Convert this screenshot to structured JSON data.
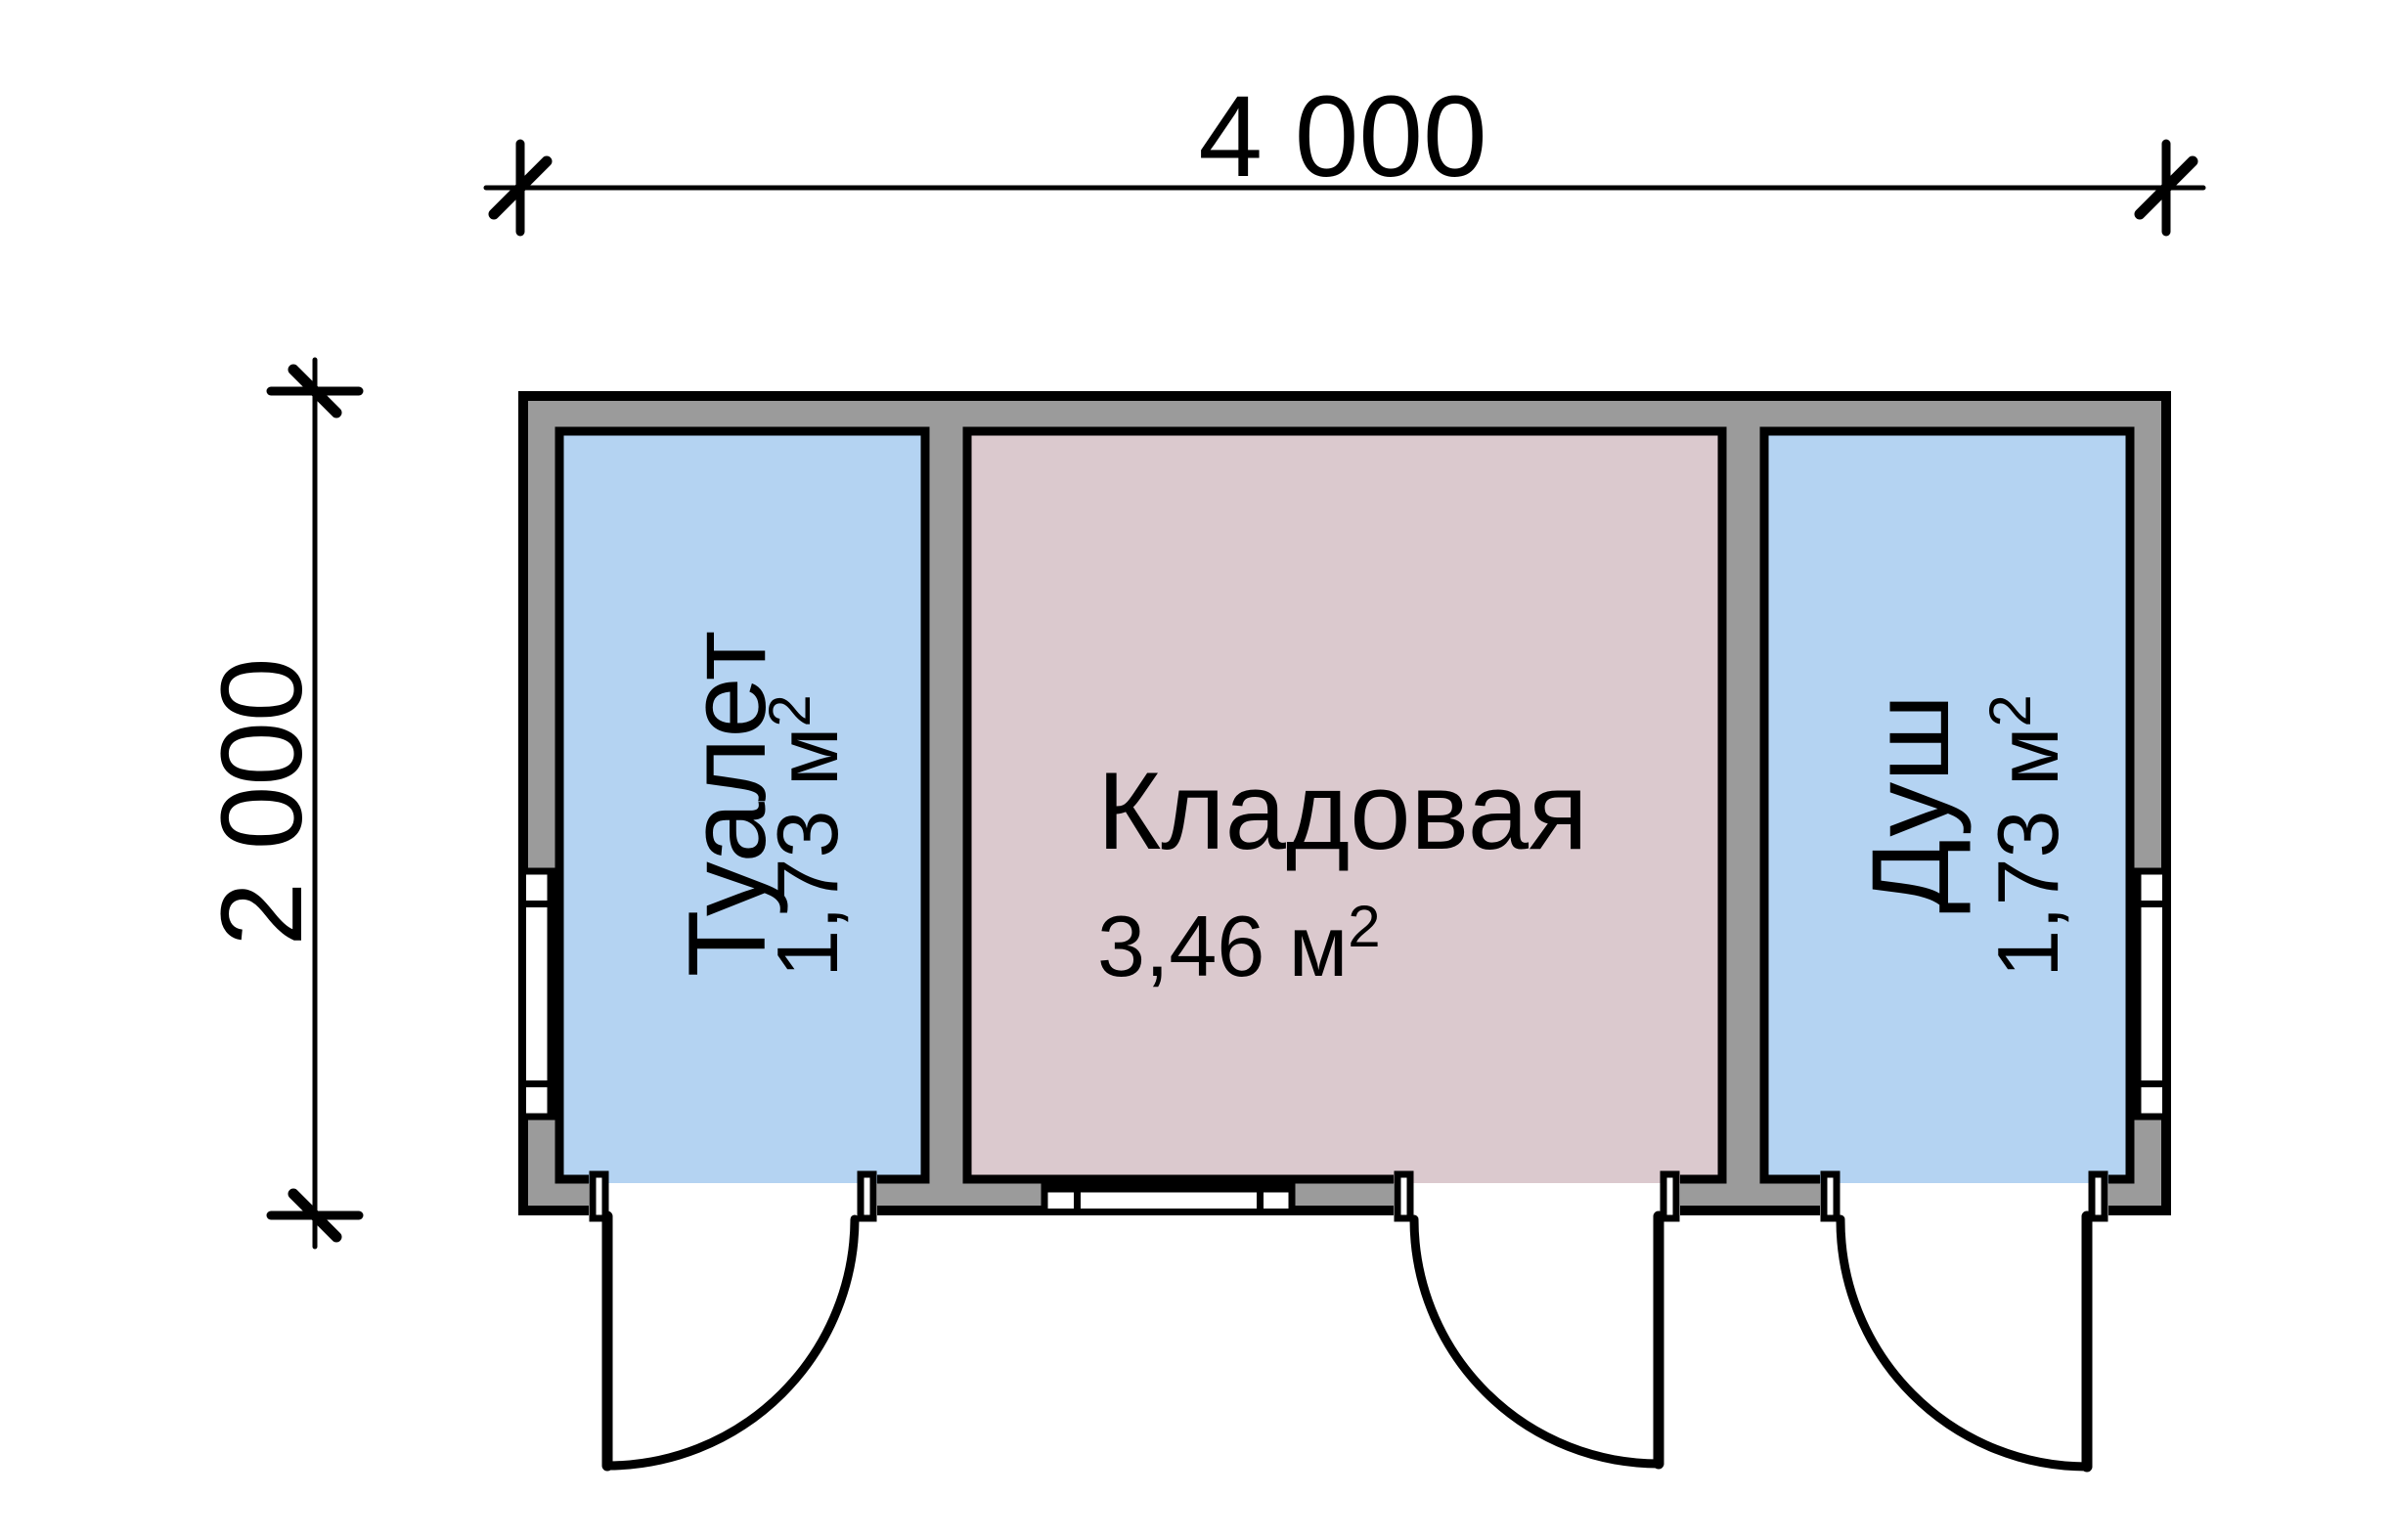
{
  "plan": {
    "type": "floor-plan",
    "dimensions": {
      "width_label": "4 000",
      "height_label": "2 000"
    },
    "rooms": [
      {
        "name": "Туалет",
        "area_value": "1,73 м",
        "area_sup": "2",
        "color": "#B4D3F2"
      },
      {
        "name": "Кладовая",
        "area_value": "3,46 м",
        "area_sup": "2",
        "color": "#DBC9CE"
      },
      {
        "name": "Душ",
        "area_value": "1,73 м",
        "area_sup": "2",
        "color": "#B4D3F2"
      }
    ],
    "colors": {
      "wall_fill": "#9B9B9B",
      "line": "#000000",
      "background": "#FFFFFF",
      "opening": "#FFFFFF"
    }
  }
}
